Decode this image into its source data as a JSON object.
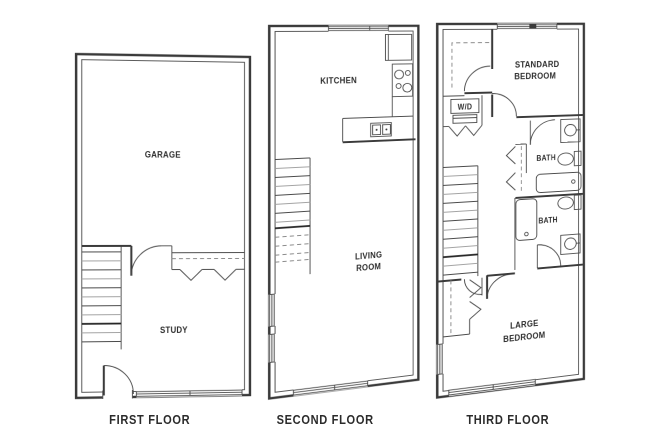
{
  "colors": {
    "background": "#ffffff",
    "wall": "#3a3a3a",
    "thin_line": "#4a4a4a",
    "light_line": "#a3a3a3",
    "text": "#2b2b2b"
  },
  "floors": [
    {
      "label": "FIRST FLOOR",
      "rooms": [
        {
          "name": "GARAGE",
          "lines": [
            "GARAGE"
          ]
        },
        {
          "name": "STUDY",
          "lines": [
            "STUDY"
          ]
        }
      ],
      "features": [
        "staircase",
        "closet-with-rod",
        "interior-door",
        "entry-door",
        "window"
      ]
    },
    {
      "label": "SECOND FLOOR",
      "rooms": [
        {
          "name": "KITCHEN",
          "lines": [
            "KITCHEN"
          ]
        },
        {
          "name": "LIVING ROOM",
          "lines": [
            "LIVING",
            "ROOM"
          ]
        }
      ],
      "features": [
        "staircase",
        "refrigerator",
        "range-cooktop",
        "kitchen-sink",
        "counter",
        "windows"
      ]
    },
    {
      "label": "THIRD FLOOR",
      "appliance_label": "W/D",
      "rooms": [
        {
          "name": "STANDARD BEDROOM",
          "lines": [
            "STANDARD",
            "BEDROOM"
          ]
        },
        {
          "name": "BATH",
          "lines": [
            "BATH"
          ]
        },
        {
          "name": "BATH",
          "lines": [
            "BATH"
          ]
        },
        {
          "name": "LARGE BEDROOM",
          "lines": [
            "LARGE",
            "BEDROOM"
          ]
        }
      ],
      "features": [
        "staircase",
        "washer-dryer-closet",
        "bathtub",
        "toilet",
        "sink",
        "bifold-closets",
        "windows"
      ]
    }
  ]
}
